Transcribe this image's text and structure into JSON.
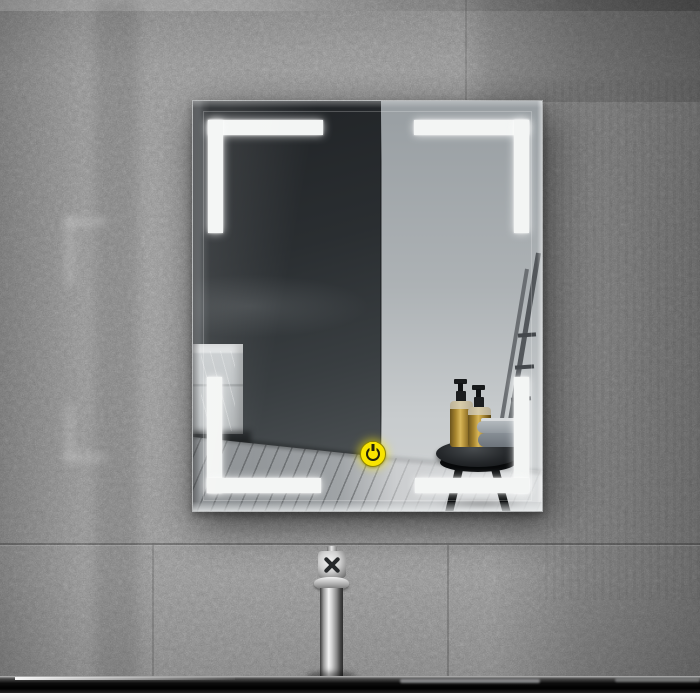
{
  "meta": {
    "description": "Product photo of a wall-mounted rectangular LED bathroom mirror with four illuminated white corner light bars and a yellow touch power button, hung on a grey terrazzo tile wall above a chrome cross-handle faucet and a glossy black counter with a white front edge. The mirror reflects a bathroom corner scene.",
    "width_px": 700,
    "height_px": 700
  },
  "palette": {
    "wall_grey": "#8f8f8f",
    "wall_shadow_right": "#616161",
    "led_white": "#f3f5f4",
    "accent_yellow": "#f8e400",
    "power_icon_dark": "#23230a",
    "chrome_highlight": "#f3f3f3",
    "counter_black": "#050505",
    "counter_front_white": "#f4f4f4",
    "bottle_gold": "#b08c3a",
    "reflection_dark_wall": "#2a2e31",
    "reflection_light_wall": "#b5babd",
    "floor_wood_grey": "#a0a4a7",
    "towel_grey": "#878e95",
    "table_black": "#17191b"
  },
  "scene": {
    "wall": {
      "label": "grey terrazzo tile wall with seams and faint LED reflections"
    },
    "mirror": {
      "label": "rectangular beveled LED mirror with four corner light bars",
      "led_brackets": {
        "label": "LED corner light bar",
        "count": 4,
        "color": "#f3f5f4"
      },
      "power_button": {
        "label": "yellow touch power button",
        "color": "#f8e400",
        "icon": "power-icon"
      },
      "reflection": {
        "label": "reflected bathroom corner",
        "dark_wall_label": "dark shadowed wall",
        "light_wall_label": "light grey wall",
        "cabinet_label": "light marble drawer cabinet",
        "floor_label": "grey wood plank floor",
        "table_label": "round black side table",
        "bottles_label": "two gold pump soap bottles",
        "towels_label": "folded grey towels",
        "ladder_label": "leaning ladder towel rack"
      }
    },
    "faucet": {
      "label": "chrome faucet column with cross handle"
    },
    "counter": {
      "label": "glossy black counter edge with white front face"
    }
  }
}
